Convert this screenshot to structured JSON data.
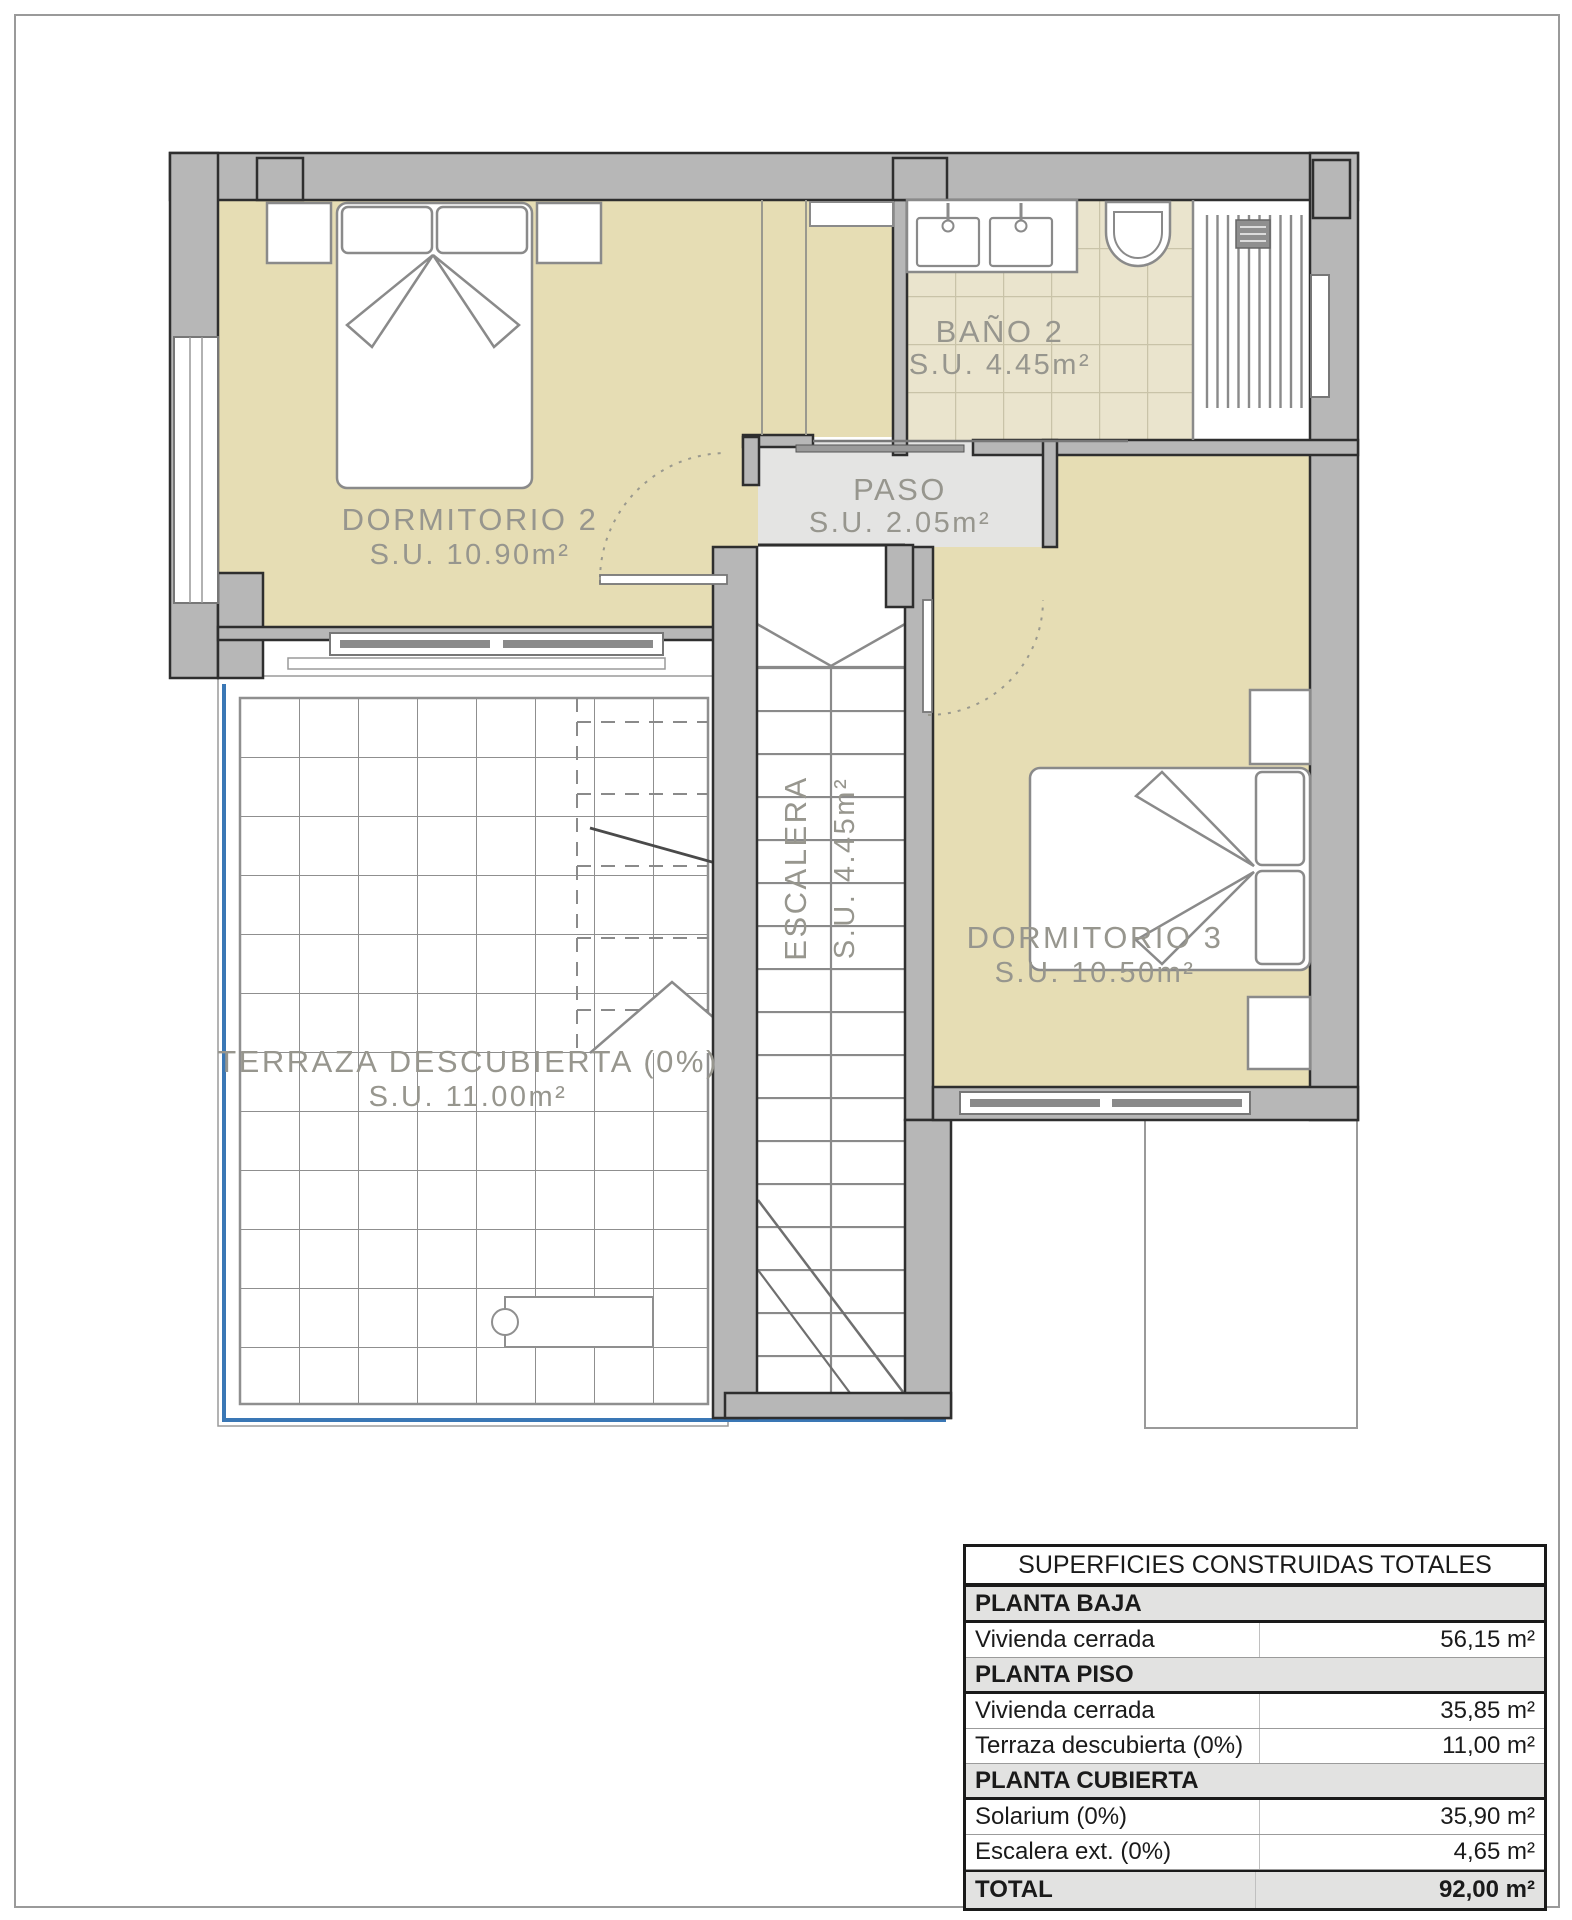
{
  "plan": {
    "rooms": {
      "dormitorio2": {
        "name": "DORMITORIO 2",
        "area": "S.U. 10.90m²"
      },
      "bano2": {
        "name": "BAÑO 2",
        "area": "S.U. 4.45m²"
      },
      "paso": {
        "name": "PASO",
        "area": "S.U. 2.05m²"
      },
      "dormitorio3": {
        "name": "DORMITORIO 3",
        "area": "S.U. 10.50m²"
      },
      "terraza": {
        "name": "TERRAZA DESCUBIERTA (0%)",
        "area": "S.U. 11.00m²"
      },
      "escalera": {
        "name": "ESCALERA",
        "area": "S.U. 4.45m²"
      }
    },
    "colors": {
      "wall": "#b7b7b7",
      "room_floor": "#e6ddb4",
      "bath_tile": "#eae4cd",
      "paso_floor": "#e4e4e3",
      "balustrade_blue": "#3a77b5"
    }
  },
  "table": {
    "title": "SUPERFICIES CONSTRUIDAS TOTALES",
    "sections": [
      {
        "header": "PLANTA BAJA",
        "rows": [
          {
            "label": "Vivienda cerrada",
            "value": "56,15 m²"
          }
        ]
      },
      {
        "header": "PLANTA PISO",
        "rows": [
          {
            "label": "Vivienda cerrada",
            "value": "35,85 m²"
          },
          {
            "label": "Terraza descubierta (0%)",
            "value": "11,00 m²"
          }
        ]
      },
      {
        "header": "PLANTA CUBIERTA",
        "rows": [
          {
            "label": "Solarium (0%)",
            "value": "35,90 m²"
          },
          {
            "label": "Escalera ext. (0%)",
            "value": "4,65 m²"
          }
        ]
      }
    ],
    "total": {
      "label": "TOTAL",
      "value": "92,00 m²"
    }
  }
}
